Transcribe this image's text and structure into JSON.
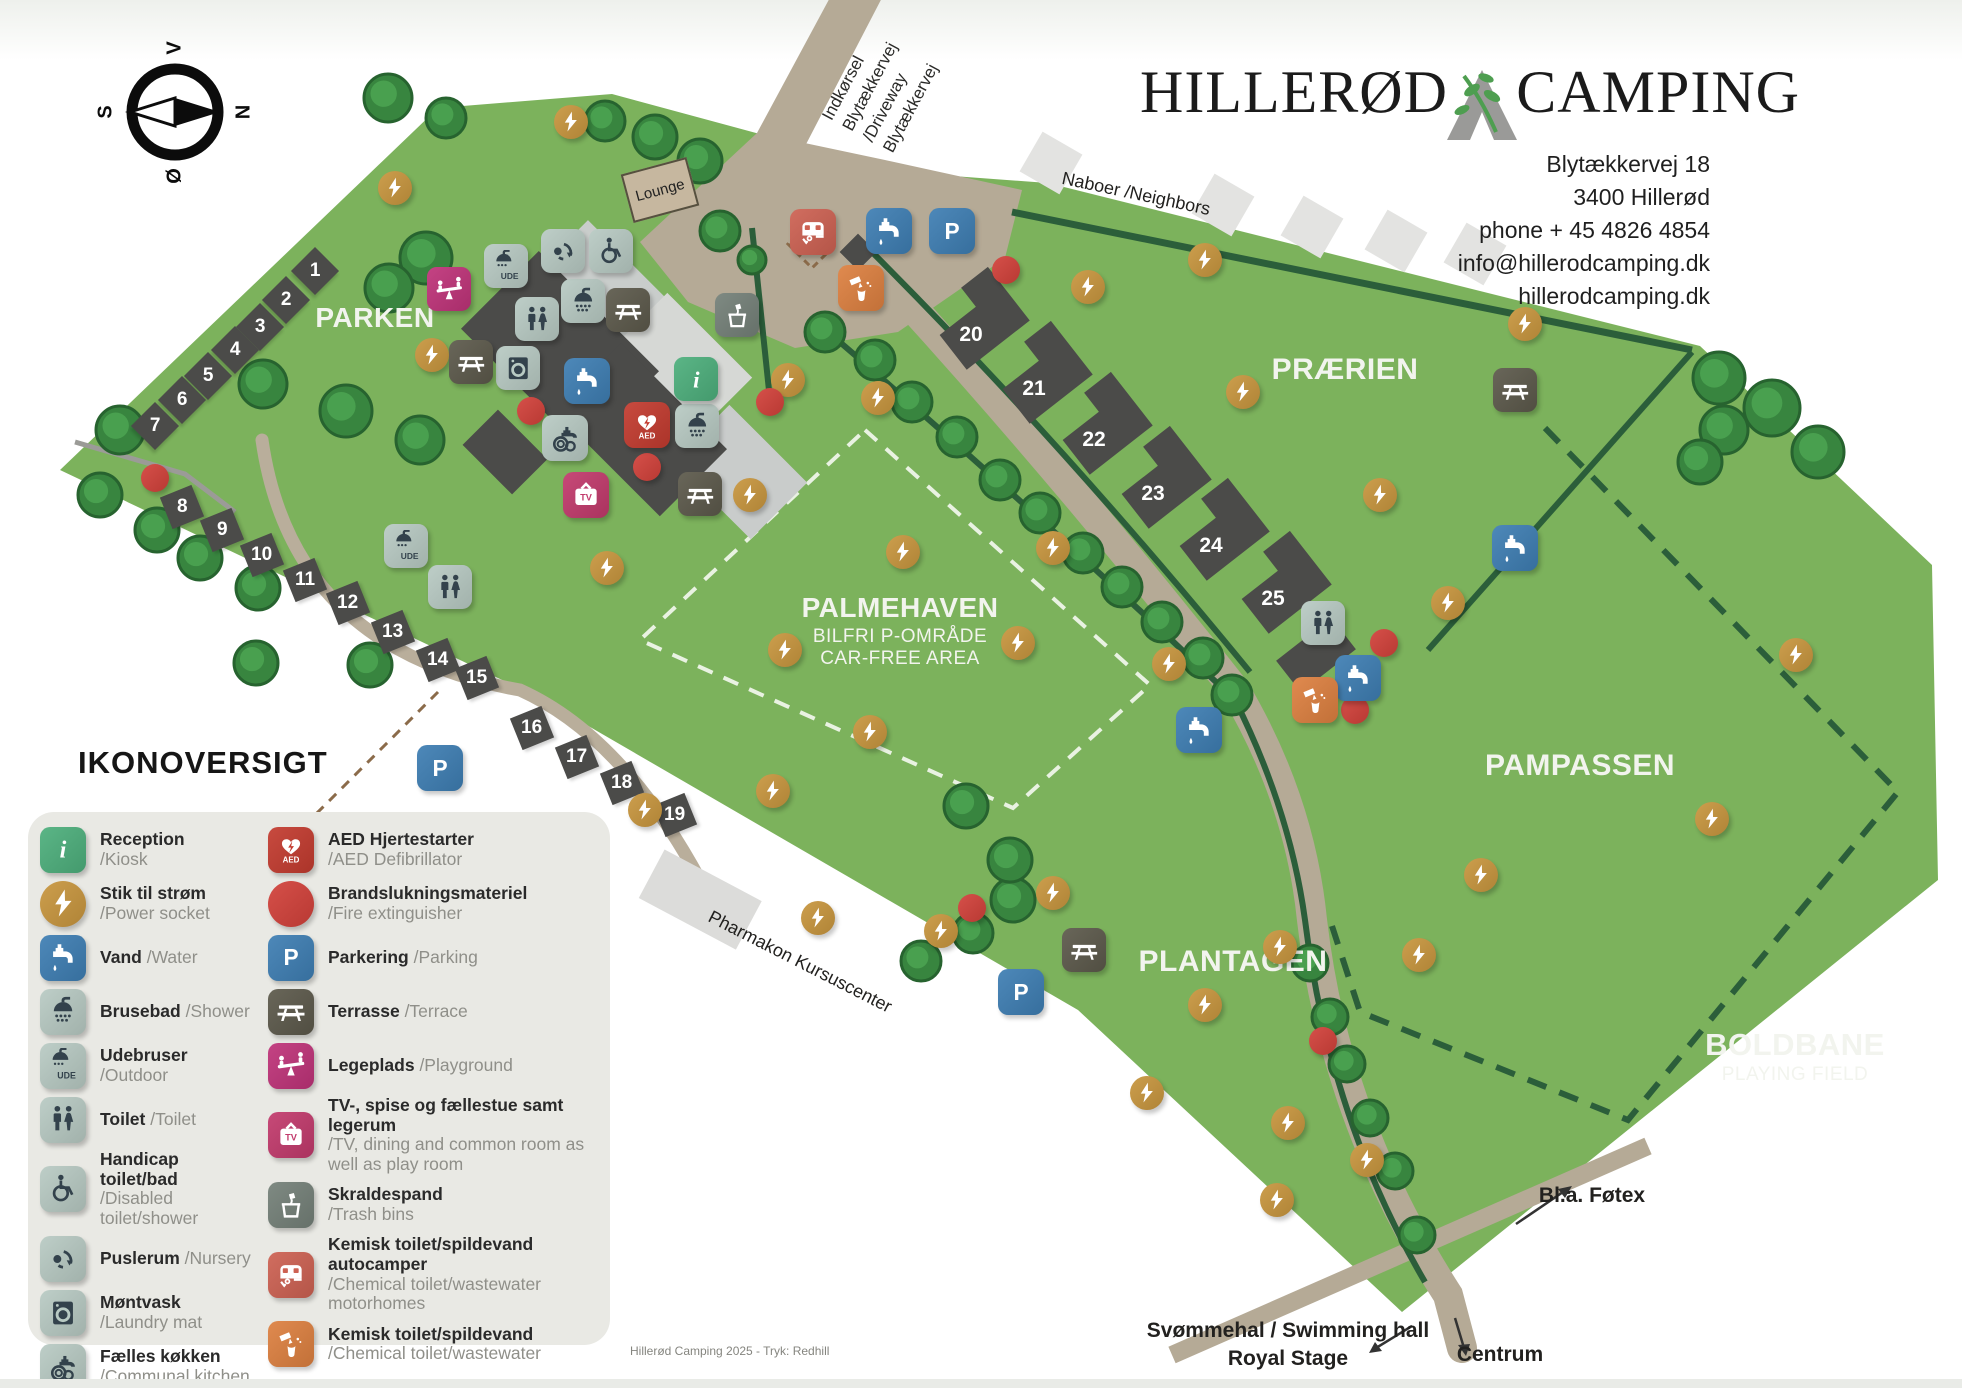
{
  "logo": {
    "left": "HILLERØD",
    "right": "CAMPING"
  },
  "address": {
    "lines": [
      "Blytækkervej 18",
      "3400 Hillerød",
      "phone + 45 4826 4854",
      "info@hillerodcamping.dk",
      "hillerodcamping.dk"
    ]
  },
  "compass": {
    "top": "V",
    "right": "N",
    "bottom": "Ø",
    "left": "S"
  },
  "regions": {
    "parken": "PARKEN",
    "praerien": "PRÆRIEN",
    "palmehaven": "PALMEHAVEN",
    "palmehaven_sub1": "BILFRI P-OMRÅDE",
    "palmehaven_sub2": "CAR-FREE AREA",
    "pampassen": "PAMPASSEN",
    "plantagen": "PLANTAGEN",
    "boldbane": "BOLDBANE",
    "boldbane_sub": "PLAYING FIELD"
  },
  "labels": {
    "entrance": [
      "Indkørsel",
      "Blytækkervej",
      "/Driveway",
      "Blytækkervej"
    ],
    "neighbors": "Naboer /Neighbors",
    "lounge": "Lounge",
    "pharmakon": "Pharmakon Kursuscenter",
    "swimming1": "Svømmehal / Swimming hall",
    "swimming2": "Royal Stage",
    "centrum": "Centrum",
    "fotex": "Bl.a. Føtex"
  },
  "map": {
    "sites": [
      {
        "n": "1",
        "x": 315,
        "y": 271
      },
      {
        "n": "2",
        "x": 286,
        "y": 300
      },
      {
        "n": "3",
        "x": 260,
        "y": 327
      },
      {
        "n": "4",
        "x": 235,
        "y": 350
      },
      {
        "n": "5",
        "x": 208,
        "y": 376
      },
      {
        "n": "6",
        "x": 182,
        "y": 400
      },
      {
        "n": "7",
        "x": 155,
        "y": 426
      },
      {
        "n": "8",
        "x": 182,
        "y": 507
      },
      {
        "n": "9",
        "x": 222,
        "y": 530
      },
      {
        "n": "10",
        "x": 262,
        "y": 555
      },
      {
        "n": "11",
        "x": 305,
        "y": 580
      },
      {
        "n": "12",
        "x": 348,
        "y": 603
      },
      {
        "n": "13",
        "x": 393,
        "y": 632
      },
      {
        "n": "14",
        "x": 438,
        "y": 660
      },
      {
        "n": "15",
        "x": 477,
        "y": 678
      },
      {
        "n": "16",
        "x": 532,
        "y": 728
      },
      {
        "n": "17",
        "x": 577,
        "y": 757
      },
      {
        "n": "18",
        "x": 622,
        "y": 783
      },
      {
        "n": "19",
        "x": 675,
        "y": 815
      }
    ],
    "cabins": [
      {
        "n": "20",
        "x": 971,
        "y": 335
      },
      {
        "n": "21",
        "x": 1034,
        "y": 389
      },
      {
        "n": "22",
        "x": 1094,
        "y": 440
      },
      {
        "n": "23",
        "x": 1153,
        "y": 494
      },
      {
        "n": "24",
        "x": 1211,
        "y": 546
      },
      {
        "n": "25",
        "x": 1273,
        "y": 599
      }
    ],
    "markers": [
      {
        "t": "power",
        "x": 395,
        "y": 188
      },
      {
        "t": "power",
        "x": 432,
        "y": 355
      },
      {
        "t": "power",
        "x": 571,
        "y": 122
      },
      {
        "t": "power",
        "x": 607,
        "y": 568
      },
      {
        "t": "power",
        "x": 750,
        "y": 495
      },
      {
        "t": "power",
        "x": 785,
        "y": 650
      },
      {
        "t": "power",
        "x": 903,
        "y": 552
      },
      {
        "t": "power",
        "x": 788,
        "y": 380
      },
      {
        "t": "power",
        "x": 878,
        "y": 398
      },
      {
        "t": "power",
        "x": 1088,
        "y": 287
      },
      {
        "t": "power",
        "x": 1205,
        "y": 260
      },
      {
        "t": "power",
        "x": 1525,
        "y": 324
      },
      {
        "t": "power",
        "x": 1243,
        "y": 392
      },
      {
        "t": "power",
        "x": 1380,
        "y": 495
      },
      {
        "t": "power",
        "x": 1448,
        "y": 603
      },
      {
        "t": "power",
        "x": 1053,
        "y": 548
      },
      {
        "t": "power",
        "x": 1018,
        "y": 643
      },
      {
        "t": "power",
        "x": 1169,
        "y": 664
      },
      {
        "t": "power",
        "x": 870,
        "y": 732
      },
      {
        "t": "power",
        "x": 773,
        "y": 791
      },
      {
        "t": "power",
        "x": 645,
        "y": 810
      },
      {
        "t": "power",
        "x": 818,
        "y": 918
      },
      {
        "t": "power",
        "x": 941,
        "y": 931
      },
      {
        "t": "power",
        "x": 1053,
        "y": 893
      },
      {
        "t": "power",
        "x": 1205,
        "y": 1005
      },
      {
        "t": "power",
        "x": 1280,
        "y": 947
      },
      {
        "t": "power",
        "x": 1419,
        "y": 955
      },
      {
        "t": "power",
        "x": 1147,
        "y": 1093
      },
      {
        "t": "power",
        "x": 1288,
        "y": 1123
      },
      {
        "t": "power",
        "x": 1367,
        "y": 1160
      },
      {
        "t": "power",
        "x": 1277,
        "y": 1200
      },
      {
        "t": "power",
        "x": 1796,
        "y": 655
      },
      {
        "t": "power",
        "x": 1712,
        "y": 819
      },
      {
        "t": "power",
        "x": 1481,
        "y": 875
      },
      {
        "t": "red",
        "x": 155,
        "y": 478
      },
      {
        "t": "red",
        "x": 531,
        "y": 411
      },
      {
        "t": "red",
        "x": 647,
        "y": 467
      },
      {
        "t": "red",
        "x": 770,
        "y": 402
      },
      {
        "t": "red",
        "x": 1006,
        "y": 270
      },
      {
        "t": "red",
        "x": 1384,
        "y": 643
      },
      {
        "t": "red",
        "x": 1355,
        "y": 710
      },
      {
        "t": "red",
        "x": 972,
        "y": 908
      },
      {
        "t": "red",
        "x": 1323,
        "y": 1041
      },
      {
        "t": "water",
        "x": 889,
        "y": 231,
        "s": 46
      },
      {
        "t": "water",
        "x": 587,
        "y": 381,
        "s": 46
      },
      {
        "t": "water",
        "x": 1358,
        "y": 678,
        "s": 46
      },
      {
        "t": "water",
        "x": 1515,
        "y": 548,
        "s": 46
      },
      {
        "t": "water",
        "x": 1199,
        "y": 730,
        "s": 46
      },
      {
        "t": "parking",
        "x": 952,
        "y": 231,
        "s": 46
      },
      {
        "t": "parking",
        "x": 440,
        "y": 768,
        "s": 46
      },
      {
        "t": "parking",
        "x": 1021,
        "y": 992,
        "s": 46
      },
      {
        "t": "wc",
        "x": 537,
        "y": 319
      },
      {
        "t": "wc",
        "x": 450,
        "y": 587
      },
      {
        "t": "wc",
        "x": 1323,
        "y": 623
      },
      {
        "t": "shower",
        "x": 583,
        "y": 301
      },
      {
        "t": "shower",
        "x": 697,
        "y": 426
      },
      {
        "t": "shower_ude",
        "x": 506,
        "y": 266
      },
      {
        "t": "shower_ude",
        "x": 406,
        "y": 546
      },
      {
        "t": "nursery",
        "x": 563,
        "y": 251
      },
      {
        "t": "handicap",
        "x": 611,
        "y": 251
      },
      {
        "t": "laundry",
        "x": 518,
        "y": 368
      },
      {
        "t": "kitchen",
        "x": 565,
        "y": 438,
        "s": 46
      },
      {
        "t": "reception",
        "x": 696,
        "y": 379
      },
      {
        "t": "aed",
        "x": 647,
        "y": 425,
        "s": 46
      },
      {
        "t": "tv",
        "x": 586,
        "y": 495,
        "s": 46
      },
      {
        "t": "playground",
        "x": 449,
        "y": 289
      },
      {
        "t": "terrace",
        "x": 628,
        "y": 310
      },
      {
        "t": "terrace",
        "x": 471,
        "y": 362
      },
      {
        "t": "terrace",
        "x": 700,
        "y": 494
      },
      {
        "t": "terrace",
        "x": 1515,
        "y": 390
      },
      {
        "t": "terrace",
        "x": 1084,
        "y": 950
      },
      {
        "t": "trash",
        "x": 737,
        "y": 315
      },
      {
        "t": "chem_caravan",
        "x": 813,
        "y": 232,
        "s": 46
      },
      {
        "t": "chem_waste",
        "x": 861,
        "y": 288,
        "s": 46
      },
      {
        "t": "chem_waste",
        "x": 1315,
        "y": 700,
        "s": 46
      }
    ]
  },
  "legend": {
    "title": "IKONOVERSIGT",
    "left": [
      {
        "icon": "reception",
        "da": "Reception",
        "en": "/Kiosk"
      },
      {
        "icon": "power",
        "da": "Stik til strøm",
        "en": "/Power socket"
      },
      {
        "icon": "water",
        "da": "Vand",
        "en": "/Water",
        "inline": true
      },
      {
        "icon": "shower",
        "da": "Brusebad",
        "en": "/Shower",
        "inline": true
      },
      {
        "icon": "shower_ude",
        "da": "Udebruser",
        "en": "/Outdoor",
        "inline": true
      },
      {
        "icon": "wc",
        "da": "Toilet",
        "en": "/Toilet",
        "inline": true
      },
      {
        "icon": "handicap",
        "da": "Handicap toilet/bad",
        "en": "/Disabled toilet/shower"
      },
      {
        "icon": "nursery",
        "da": "Puslerum",
        "en": "/Nursery",
        "inline": true
      },
      {
        "icon": "laundry",
        "da": "Møntvask",
        "en": "/Laundry mat"
      },
      {
        "icon": "kitchen",
        "da": "Fælles køkken",
        "en": "/Communal kitchen"
      }
    ],
    "right": [
      {
        "icon": "aed",
        "da": "AED Hjertestarter",
        "en": "/AED Defibrillator"
      },
      {
        "icon": "red",
        "da": "Brandslukningsmateriel",
        "en": "/Fire extinguisher"
      },
      {
        "icon": "parking",
        "da": "Parkering",
        "en": "/Parking",
        "inline": true
      },
      {
        "icon": "terrace",
        "da": "Terrasse",
        "en": "/Terrace",
        "inline": true
      },
      {
        "icon": "playground",
        "da": "Legeplads",
        "en": "/Playground",
        "inline": true
      },
      {
        "icon": "tv",
        "da": "TV-, spise og fællestue samt legerum",
        "en": "/TV, dining and common room as well as play room"
      },
      {
        "icon": "trash",
        "da": "Skraldespand",
        "en": "/Trash bins"
      },
      {
        "icon": "chem_caravan",
        "da": "Kemisk toilet/spildevand autocamper",
        "en": "/Chemical toilet/wastewater motorhomes"
      },
      {
        "icon": "chem_waste",
        "da": "Kemisk toilet/spildevand",
        "en": "/Chemical toilet/wastewater"
      }
    ]
  },
  "footer": "Hillerød Camping 2025 - Tryk: Redhill"
}
